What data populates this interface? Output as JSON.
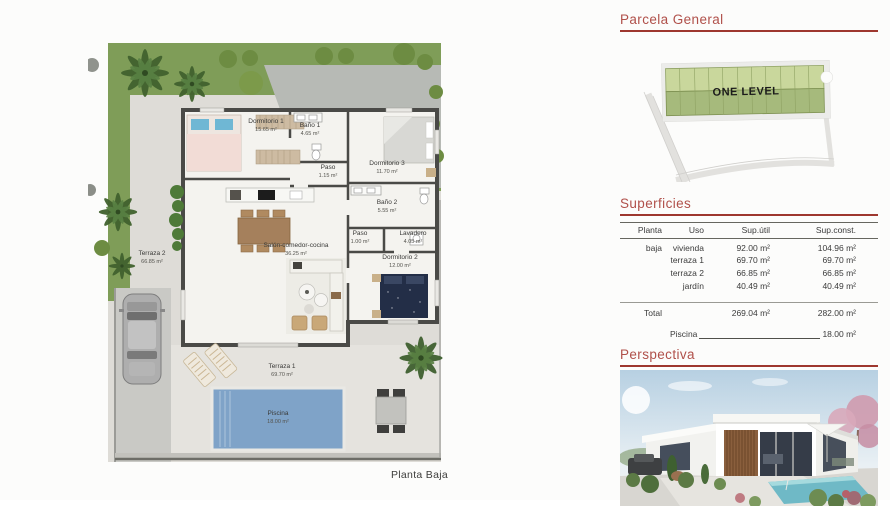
{
  "floorplan": {
    "caption": "Planta Baja",
    "rooms": [
      {
        "name": "Dormitorio 1",
        "area": "15.65 m²"
      },
      {
        "name": "Baño 1",
        "area": "4.65 m²"
      },
      {
        "name": "Paso",
        "area": "1.15 m²"
      },
      {
        "name": "Dormitorio 3",
        "area": "11.70 m²"
      },
      {
        "name": "Baño 2",
        "area": "5.55 m²"
      },
      {
        "name": "Paso",
        "area": "1.00 m²"
      },
      {
        "name": "Lavadero",
        "area": "4.05 m²"
      },
      {
        "name": "Salón-comedor-cocina",
        "area": "36.25 m²"
      },
      {
        "name": "Dormitorio 2",
        "area": "12.00 m²"
      },
      {
        "name": "Terraza 2",
        "area": "66.85 m²"
      },
      {
        "name": "Terraza 1",
        "area": "69.70 m²"
      },
      {
        "name": "Piscina",
        "area": "18.00 m²"
      }
    ]
  },
  "parcela": {
    "title": "Parcela General",
    "label": "ONE LEVEL"
  },
  "superficies": {
    "title": "Superficies",
    "columns": [
      "Planta",
      "Uso",
      "Sup.útil",
      "Sup.const."
    ],
    "rows": [
      {
        "planta": "baja",
        "uso": "vivienda",
        "util": "92.00 m²",
        "const": "104.96 m²"
      },
      {
        "planta": "",
        "uso": "terraza 1",
        "util": "69.70 m²",
        "const": "69.70 m²"
      },
      {
        "planta": "",
        "uso": "terraza 2",
        "util": "66.85 m²",
        "const": "66.85 m²"
      },
      {
        "planta": "",
        "uso": "jardín",
        "util": "40.49 m²",
        "const": "40.49 m²"
      }
    ],
    "total": {
      "label": "Total",
      "util": "269.04 m²",
      "const": "282.00 m²"
    },
    "piscina": {
      "label": "Piscina",
      "value": "18.00 m²"
    }
  },
  "perspectiva": {
    "title": "Perspectiva"
  },
  "colors": {
    "heading": "#b0504a",
    "rule": "#9e372f",
    "wall": "#4a4a47",
    "grass": "#7f9d58",
    "paving": "#b7bab5",
    "terrace": "#dedcd7",
    "pool": "#7fa3c8",
    "parcel_light": "#c9d79c",
    "parcel_dark": "#a6ba7c",
    "table_text": "#3b3b3b"
  }
}
